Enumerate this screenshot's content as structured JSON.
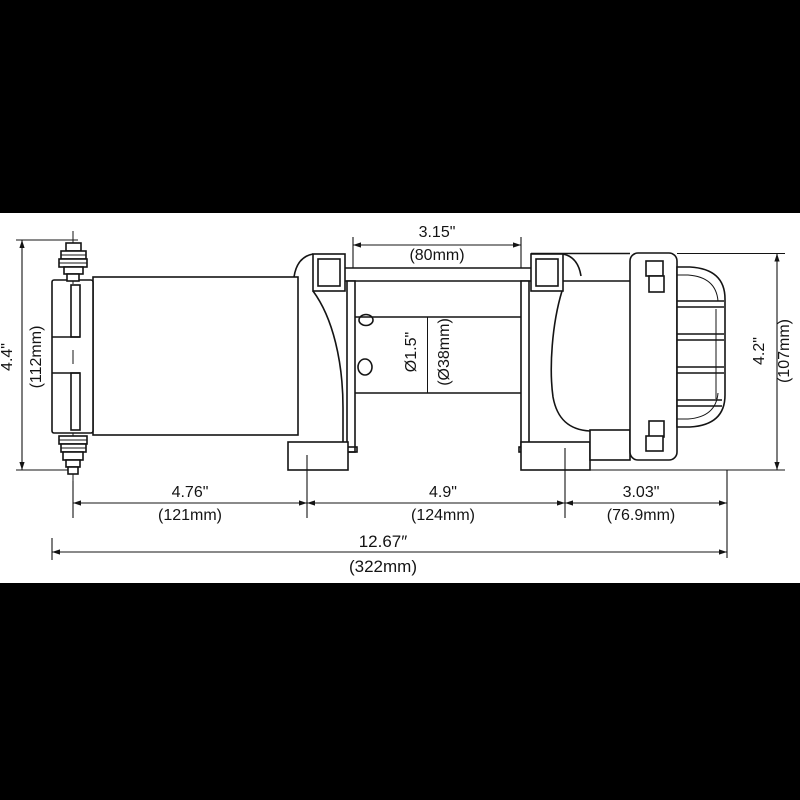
{
  "figure": {
    "kind": "technical dimension drawing",
    "subject": "electric winch side view"
  },
  "colors": {
    "letterbox": "#000000",
    "paper": "#ffffff",
    "line": "#141414"
  },
  "dimensions": {
    "drum_width": {
      "inches": "3.15\"",
      "mm": "(80mm)"
    },
    "left_height": {
      "inches": "4.4\"",
      "mm": "(112mm)"
    },
    "right_height": {
      "inches": "4.2\"",
      "mm": "(107mm)"
    },
    "drum_diameter": {
      "inches": "Ø1.5\"",
      "mm": "(Ø38mm)"
    },
    "motor_length": {
      "inches": "4.76\"",
      "mm": "(121mm)"
    },
    "center_length": {
      "inches": "4.9\"",
      "mm": "(124mm)"
    },
    "gearbox_length": {
      "inches": "3.03\"",
      "mm": "(76.9mm)"
    },
    "overall_length": {
      "inches": "12.67″",
      "mm": "(322mm)"
    }
  }
}
